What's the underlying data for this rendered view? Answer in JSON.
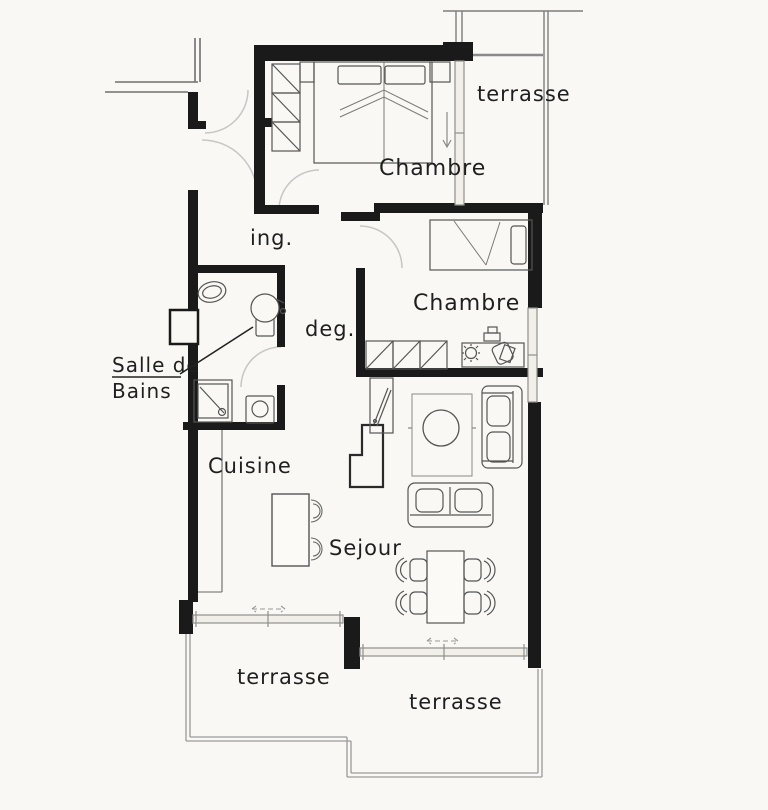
{
  "plan": {
    "colors": {
      "paper": "#f9f8f4",
      "wall": "#1a1a1a",
      "furniture_line": "#555555",
      "window_line": "#8f8f8f",
      "door_arc": "#c6c6c6",
      "terrace_line": "#9a9a9a",
      "label_text": "#1f1f1f"
    },
    "labels": {
      "terrace_top": "terrasse",
      "bedroom_top": "Chambre",
      "entry": "ing.",
      "bedroom_middle": "Chambre",
      "hallway": "deg.",
      "bathroom_line1": "Salle de",
      "bathroom_line2": "Bains",
      "kitchen": "Cuisine",
      "living_room": "Sejour",
      "terrace_bottom_left": "terrasse",
      "terrace_bottom_right": "terrasse"
    }
  }
}
